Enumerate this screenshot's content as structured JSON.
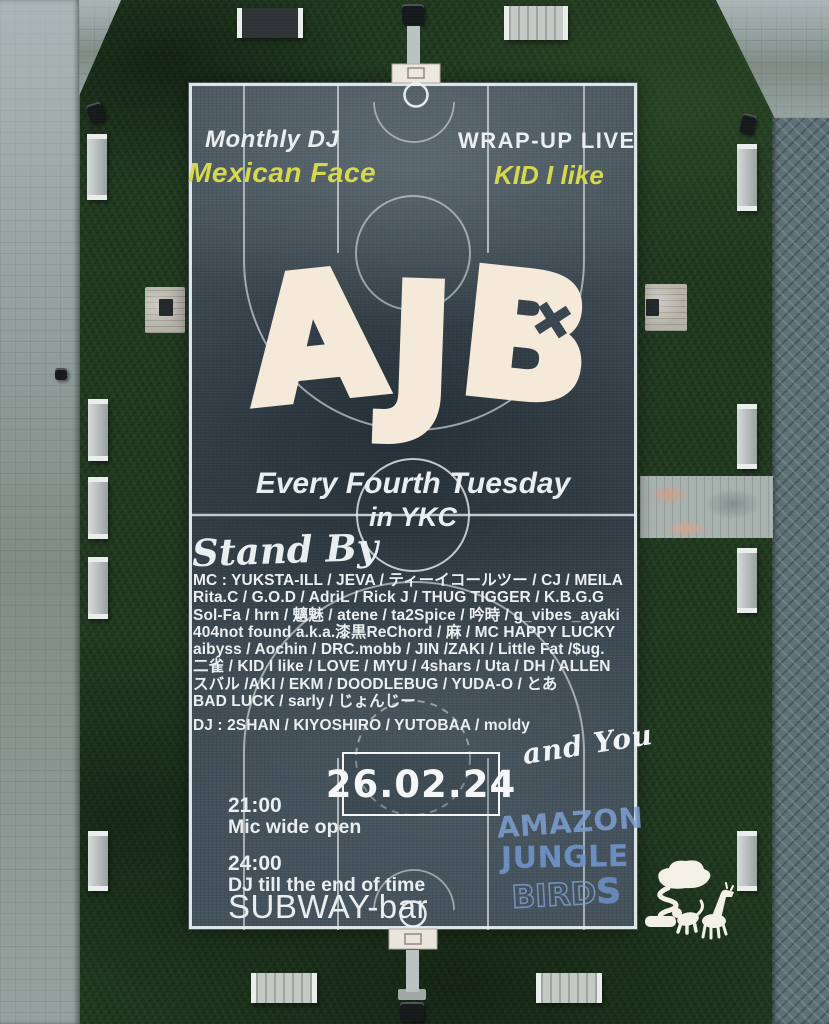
{
  "poster": {
    "event_series_left": "Monthly DJ",
    "event_series_right": "WRAP-UP LIVE",
    "artist_left": "Mexican Face",
    "artist_right": "KID I like",
    "logo": {
      "letters": [
        "A",
        "J",
        "B"
      ],
      "cross": "✕"
    },
    "schedule_line1": "Every Fourth Tuesday",
    "schedule_line2": "in YKC",
    "standby_heading": "Stand By",
    "mc_lines": [
      "MC : YUKSTA-ILL / JEVA / ティーイコールツー / CJ / MEILA",
      "Rita.C / G.O.D / AdriL / Rick J / THUG TIGGER / K.B.G.G",
      "Sol-Fa / hrn / 魑魅 / atene / ta2Spice / 吟時 / g_vibes_ayaki",
      "404not found a.k.a.漆黒ReChord / 麻 / MC HAPPY LUCKY",
      "aibyss / Aochin / DRC.mobb / JIN /ZAKI / Little Fat /$ug.",
      "二雀 / KID I like / LOVE / MYU / 4shars / Uta / DH / ALLEN",
      "スバル /AKI / EKM / DOODLEBUG / YUDA-O / とあ",
      "BAD LUCK / sarly / じょんじー"
    ],
    "dj_line": "DJ : 2SHAN / KIYOSHIRO / YUTOBAA / moldy",
    "and_you": "and You",
    "date": "26.02.24",
    "time_1": "21:00",
    "time_1_desc": "Mic wide open",
    "time_2": "24:00",
    "time_2_desc": "DJ till the end of time",
    "venue": "SUBWAY-bar",
    "crew_graffiti": {
      "line1": "AMAZON",
      "line2": "JUNGLE",
      "line3": "BIRDS",
      "line3_outline": "BIRD",
      "line3_solid": "S"
    }
  },
  "colors": {
    "accent_yellow": "#d6d84e",
    "cream": "#f5ead9",
    "graffiti_blue": "#7d9fd2",
    "court_slate": "#3d4a53",
    "grass_green": "#20381f",
    "line_white": "#e9eef0"
  }
}
